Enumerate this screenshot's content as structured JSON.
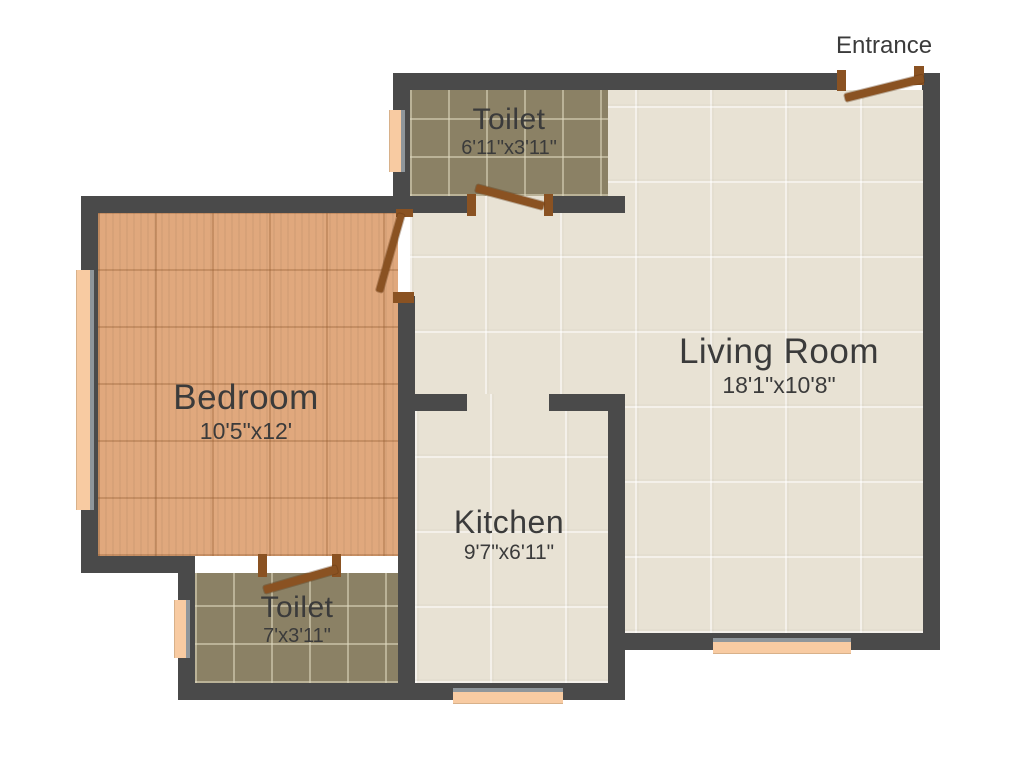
{
  "entrance": {
    "label": "Entrance"
  },
  "rooms": {
    "toilet_top": {
      "name": "Toilet",
      "dimensions": "6'11\"x3'11\""
    },
    "living_room": {
      "name": "Living Room",
      "dimensions": "18'1\"x10'8\""
    },
    "bedroom": {
      "name": "Bedroom",
      "dimensions": "10'5\"x12'"
    },
    "kitchen": {
      "name": "Kitchen",
      "dimensions": "9'7\"x6'11\""
    },
    "toilet_bottom": {
      "name": "Toilet",
      "dimensions": "7'x3'11\""
    }
  },
  "colors": {
    "background": "#ffffff",
    "wall": "#4a4a4a",
    "door": "#8a5222",
    "window": "#f8cba2",
    "window_frame": "#8f969b",
    "bedroom_floor": "#e0a87d",
    "toilet_floor": "#8b8165",
    "tile_floor": "#e8e2d4",
    "label_text": "#3b3b3b"
  }
}
